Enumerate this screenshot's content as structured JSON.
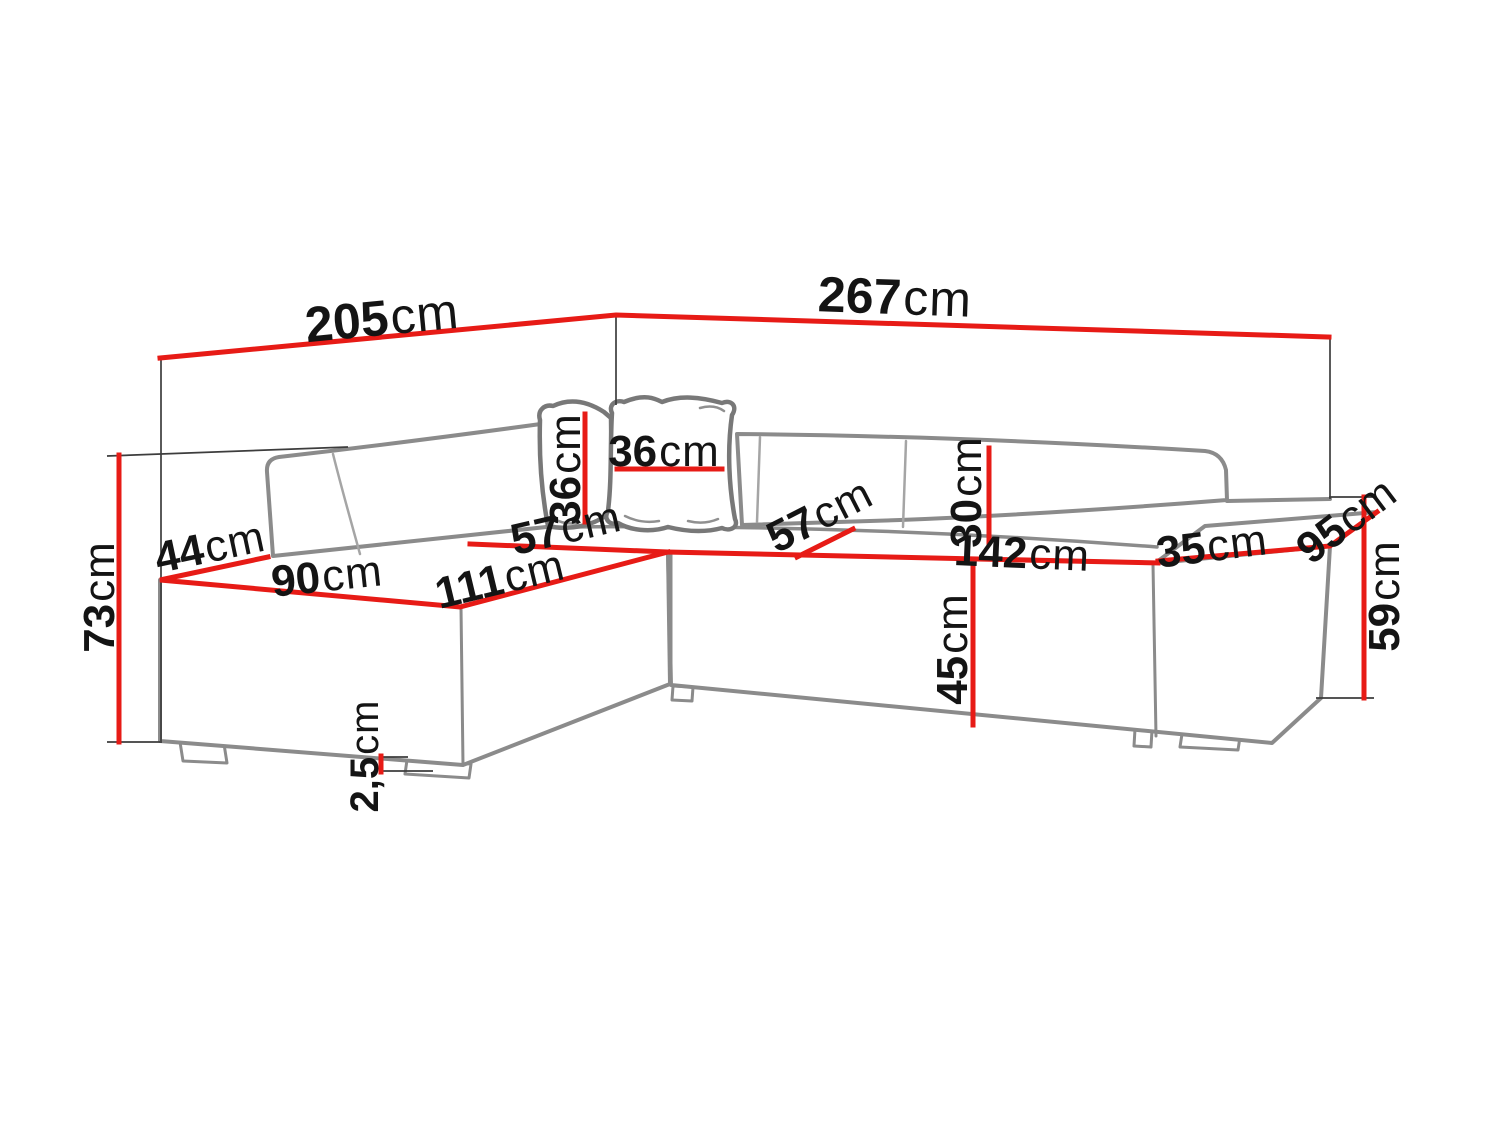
{
  "diagram": {
    "type": "corner-sofa-dimension-diagram",
    "unit": "cm"
  },
  "colors": {
    "background": "#ffffff",
    "dimension_line": "#e71b16",
    "extension_line": "#3d3d3d",
    "sofa_outline": "#8b8b8b",
    "label_text": "#141414"
  },
  "dimensions": {
    "d205": {
      "value": "205",
      "unit": "cm"
    },
    "d267": {
      "value": "267",
      "unit": "cm"
    },
    "d73": {
      "value": "73",
      "unit": "cm"
    },
    "d44": {
      "value": "44",
      "unit": "cm"
    },
    "d90": {
      "value": "90",
      "unit": "cm"
    },
    "d111": {
      "value": "111",
      "unit": "cm"
    },
    "d57_left": {
      "value": "57",
      "unit": "cm"
    },
    "d36_left": {
      "value": "36",
      "unit": "cm"
    },
    "d36_right": {
      "value": "36",
      "unit": "cm"
    },
    "d57_right": {
      "value": "57",
      "unit": "cm"
    },
    "d30": {
      "value": "30",
      "unit": "cm"
    },
    "d142": {
      "value": "142",
      "unit": "cm"
    },
    "d45": {
      "value": "45",
      "unit": "cm"
    },
    "d35": {
      "value": "35",
      "unit": "cm"
    },
    "d95": {
      "value": "95",
      "unit": "cm"
    },
    "d59": {
      "value": "59",
      "unit": "cm"
    },
    "d2_5": {
      "value": "2,5",
      "unit": "cm"
    }
  }
}
